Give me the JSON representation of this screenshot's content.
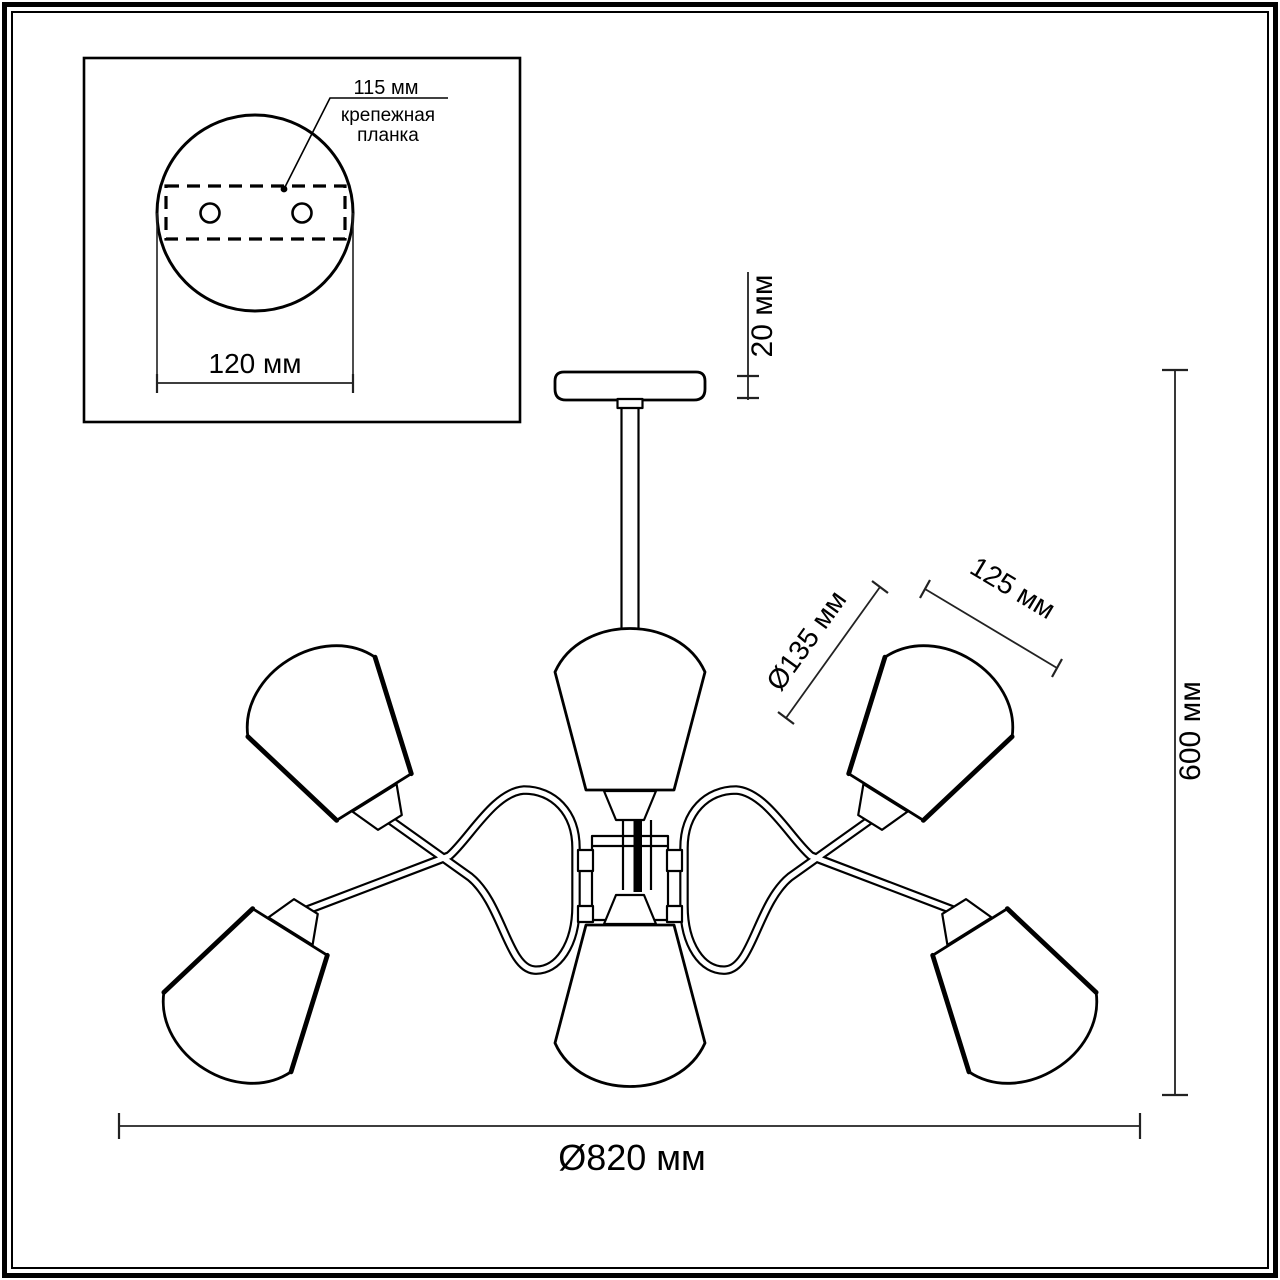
{
  "page": {
    "background": "#ffffff",
    "line_color": "#000000"
  },
  "inset": {
    "hole_spacing": "115 мм",
    "plate_label_line1": "крепежная",
    "plate_label_line2": "планка",
    "canopy_diameter": "120 мм"
  },
  "dimensions": {
    "canopy_height": "20 мм",
    "shade_diameter": "Ø135 мм",
    "shade_height": "125 мм",
    "fixture_height": "600 мм",
    "fixture_diameter": "Ø820 мм"
  }
}
